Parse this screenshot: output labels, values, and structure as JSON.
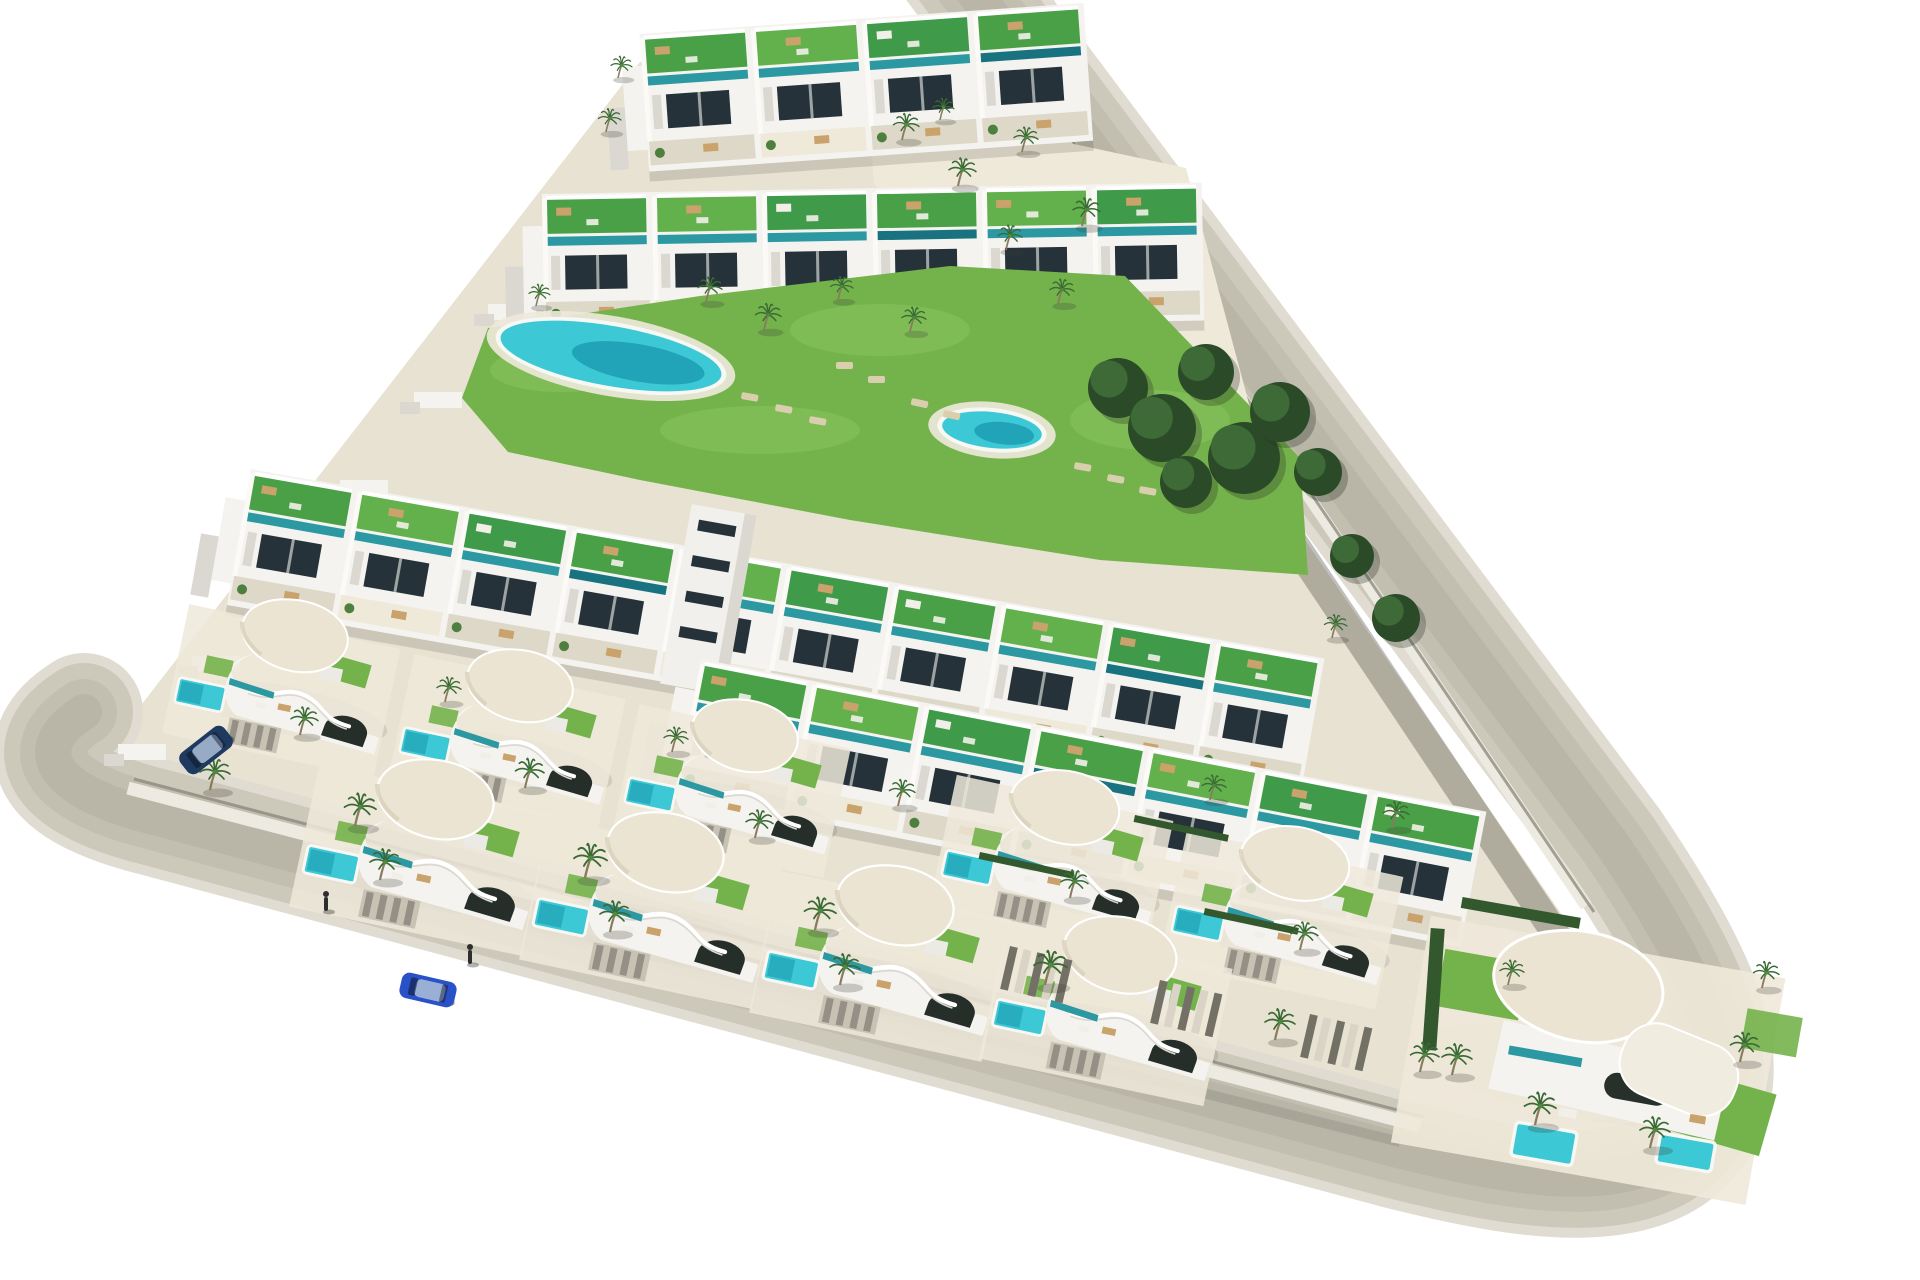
{
  "scene": {
    "description": "Aerial 3D architectural render of a triangular coastal residential development with white terraced apartments, curved villas, rooftop gardens, swimming pools, palm trees and a perimeter road",
    "canvas": {
      "width": 1920,
      "height": 1280,
      "background": "#ffffff"
    },
    "palette": {
      "sand": "#e8e2d2",
      "sandLight": "#efe9da",
      "roadLayers": [
        "#e0dcd1",
        "#ccc8ba",
        "#c2beb0",
        "#b9b5a7"
      ],
      "roadWidths": [
        118,
        98,
        66,
        36
      ],
      "sidewalk": "#edebe1",
      "curb": "#8f8c80",
      "white": "#f4f3ef",
      "whiteShade": "#dbd8d1",
      "whiteDark": "#c6c3bb",
      "window": "#26323a",
      "teal": "#2c98a2",
      "tealDark": "#187280",
      "aqua": "#3cc8d5",
      "aquaDeep": "#1897ad",
      "poolRim": "#f7f7f3",
      "lawn": "#74b34b",
      "lawnLight": "#8ac260",
      "lawnDark": "#579a3b",
      "roofGreens": [
        "#4aa047",
        "#63b14d",
        "#3f9a49"
      ],
      "hedge": "#33582e",
      "cream": "#ece4d2",
      "creamEdge": "#d8cfba",
      "palmFrond": "#3a6a34",
      "palmTrunk": "#8a7b5f",
      "palmCore": "#4e8a3e",
      "treeDark": "#2b4b28",
      "treeMid": "#3d6a36",
      "furniture": "#c9a26c",
      "furnitureWhite": "#f1efe8",
      "lounger": "#d9cfae",
      "shadow": "rgba(70,72,62,0.30)",
      "roadShadow": "rgba(42,46,40,0.30)",
      "carBlue": "#2a52c8",
      "carNavy": "#1f3a5f",
      "person": "#2e2e2e"
    },
    "ground": {
      "points": "100,758 640,62 950,22 1560,912 1646,1046 1608,1146 1430,1148 170,820"
    },
    "roads": {
      "center": "M 84,712 C 30,746 42,790 158,818 L 1398,1150 C 1532,1184 1650,1200 1698,1128 C 1738,1066 1706,984 1612,844 L 950,-40",
      "sidewalkBottom": "M 128,788 L 1420,1126",
      "sidewalkRight": "M 986,20 L 1586,906",
      "curbBottom": "M 134,779 L 1424,1117",
      "curbRight": "M 995,26 L 1594,912",
      "shadowRight": "M 1062,196 L 1600,1000",
      "shadowBottom": "M 300,868 L 1400,1142"
    },
    "steps": {
      "x0": 118,
      "y0": 744,
      "dx": 74,
      "dy": -88,
      "count": 6
    },
    "plaza": {
      "points": "868,100 1186,168 1256,430 1120,268 944,258 874,184"
    },
    "walkway": {
      "points": "1052,236 1074,230 1204,474 1180,482"
    },
    "green": {
      "points": "462,398 488,328 700,296 950,266 1125,276 1300,458 1308,575 1100,560 850,520 640,480 508,452",
      "patches": [
        [
          560,
          370,
          70,
          22
        ],
        [
          880,
          330,
          90,
          26
        ],
        [
          1150,
          420,
          80,
          30
        ],
        [
          760,
          430,
          100,
          24
        ]
      ]
    },
    "pools": {
      "main": {
        "cx": 611,
        "cy": 356,
        "rx": 112,
        "ry": 30,
        "angle": 10
      },
      "round": {
        "cx": 992,
        "cy": 430,
        "rx": 50,
        "ry": 18,
        "angle": 6
      }
    },
    "loungers": [
      [
        742,
        392,
        10
      ],
      [
        776,
        404,
        10
      ],
      [
        810,
        416,
        10
      ],
      [
        912,
        398,
        12
      ],
      [
        944,
        410,
        12
      ],
      [
        1075,
        462,
        10
      ],
      [
        1108,
        474,
        10
      ],
      [
        1140,
        486,
        10
      ],
      [
        836,
        362,
        0
      ],
      [
        868,
        376,
        0
      ]
    ],
    "trees": [
      [
        1118,
        388,
        30
      ],
      [
        1162,
        428,
        34
      ],
      [
        1206,
        372,
        28
      ],
      [
        1244,
        458,
        36
      ],
      [
        1280,
        412,
        30
      ],
      [
        1186,
        482,
        26
      ],
      [
        1318,
        472,
        24
      ],
      [
        1352,
        556,
        22
      ],
      [
        1396,
        618,
        24
      ]
    ],
    "bands": [
      {
        "name": "apartment-row-top",
        "x": 640,
        "y": 40,
        "angle": -4,
        "len": 445,
        "cells": 4
      },
      {
        "name": "apartment-row-second",
        "x": 542,
        "y": 200,
        "angle": -1,
        "len": 660,
        "cells": 6
      },
      {
        "name": "apartment-row-third",
        "x": 250,
        "y": 475,
        "angle": 10,
        "len": 1090,
        "cells": 10,
        "tower": 440
      },
      {
        "name": "apartment-row-fourth",
        "x": 700,
        "y": 665,
        "angle": 11,
        "len": 800,
        "cells": 7
      }
    ],
    "villaAngle": 12,
    "villasBack": [
      [
        290,
        650,
        0.8
      ],
      [
        515,
        700,
        0.8
      ],
      [
        740,
        750,
        0.8
      ]
    ],
    "villasRight": [
      [
        1060,
        822,
        0.82
      ],
      [
        1290,
        878,
        0.82
      ]
    ],
    "villasFront": [
      [
        430,
        815,
        0.88
      ],
      [
        660,
        868,
        0.88
      ],
      [
        890,
        921,
        0.88
      ],
      [
        1115,
        970,
        0.85
      ]
    ],
    "cornerVilla": {
      "x": 1596,
      "y": 1016,
      "angle": 10
    },
    "driveways": [
      [
        1010,
        946,
        13
      ],
      [
        1160,
        980,
        13
      ],
      [
        1310,
        1014,
        13
      ]
    ],
    "hedges": [
      [
        980,
        852,
        12
      ],
      [
        1205,
        908,
        12
      ],
      [
        1135,
        815,
        12
      ]
    ],
    "palms": [
      [
        210,
        790,
        1.0
      ],
      [
        355,
        826,
        1.05
      ],
      [
        585,
        878,
        1.1
      ],
      [
        815,
        930,
        1.05
      ],
      [
        1045,
        985,
        1.1
      ],
      [
        1275,
        1040,
        1.0
      ],
      [
        1420,
        1072,
        0.95
      ],
      [
        300,
        735,
        0.9
      ],
      [
        525,
        788,
        0.95
      ],
      [
        755,
        838,
        0.9
      ],
      [
        445,
        702,
        0.8
      ],
      [
        672,
        752,
        0.8
      ],
      [
        898,
        806,
        0.85
      ],
      [
        380,
        880,
        1.0
      ],
      [
        610,
        932,
        1.0
      ],
      [
        840,
        985,
        1.0
      ],
      [
        1070,
        898,
        0.9
      ],
      [
        1300,
        950,
        0.9
      ],
      [
        1392,
        828,
        0.85
      ],
      [
        1210,
        800,
        0.8
      ],
      [
        1332,
        638,
        0.75
      ],
      [
        1452,
        1075,
        1.0
      ],
      [
        1535,
        1125,
        1.05
      ],
      [
        1650,
        1148,
        1.0
      ],
      [
        1740,
        1062,
        0.95
      ],
      [
        1762,
        988,
        0.85
      ],
      [
        1508,
        985,
        0.8
      ],
      [
        706,
        302,
        0.8
      ],
      [
        764,
        330,
        0.85
      ],
      [
        838,
        300,
        0.75
      ],
      [
        910,
        332,
        0.8
      ],
      [
        1058,
        304,
        0.8
      ],
      [
        536,
        306,
        0.7
      ],
      [
        902,
        140,
        0.85
      ],
      [
        958,
        186,
        0.9
      ],
      [
        1022,
        152,
        0.8
      ],
      [
        1082,
        226,
        0.9
      ],
      [
        1006,
        250,
        0.8
      ],
      [
        940,
        120,
        0.7
      ],
      [
        618,
        78,
        0.7
      ],
      [
        606,
        132,
        0.75
      ]
    ],
    "vehicles": [
      {
        "name": "car-driving-blue",
        "x": 428,
        "y": 990,
        "angle": 13,
        "color": "#2a52c8"
      },
      {
        "name": "car-parked-navy",
        "x": 206,
        "y": 750,
        "angle": -38,
        "color": "#1f3a5f"
      }
    ],
    "pedestrians": [
      [
        326,
        903
      ],
      [
        470,
        956
      ]
    ]
  }
}
